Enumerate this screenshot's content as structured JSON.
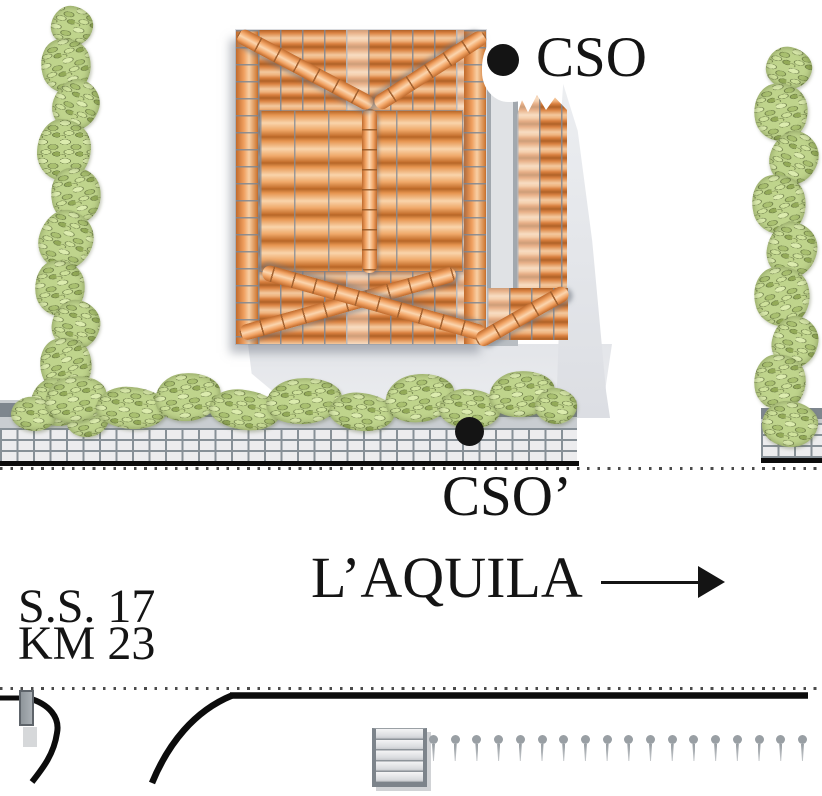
{
  "labels": {
    "cso_top": "CSO",
    "cso_bottom": "CSO’",
    "destination": "L’AQUILA",
    "road_line1": "S.S. 17",
    "road_line2": "KM 23"
  },
  "icons": {
    "cso_top_marker": "filled-circle",
    "cso_bottom_marker": "filled-circle",
    "direction_arrow": "right-arrow"
  },
  "colors": {
    "roof_tile_orange": "#da8342",
    "roof_tile_highlight": "#f3c89d",
    "hedge_green": "#bfd48c",
    "wall_gray": "#7e868e",
    "sidewalk_tile": "#ececee",
    "shadow_gray": "#e3e5e9",
    "marker_black": "#141414",
    "road_line_black": "#0c0c0c",
    "post_gray": "#999fa4"
  }
}
